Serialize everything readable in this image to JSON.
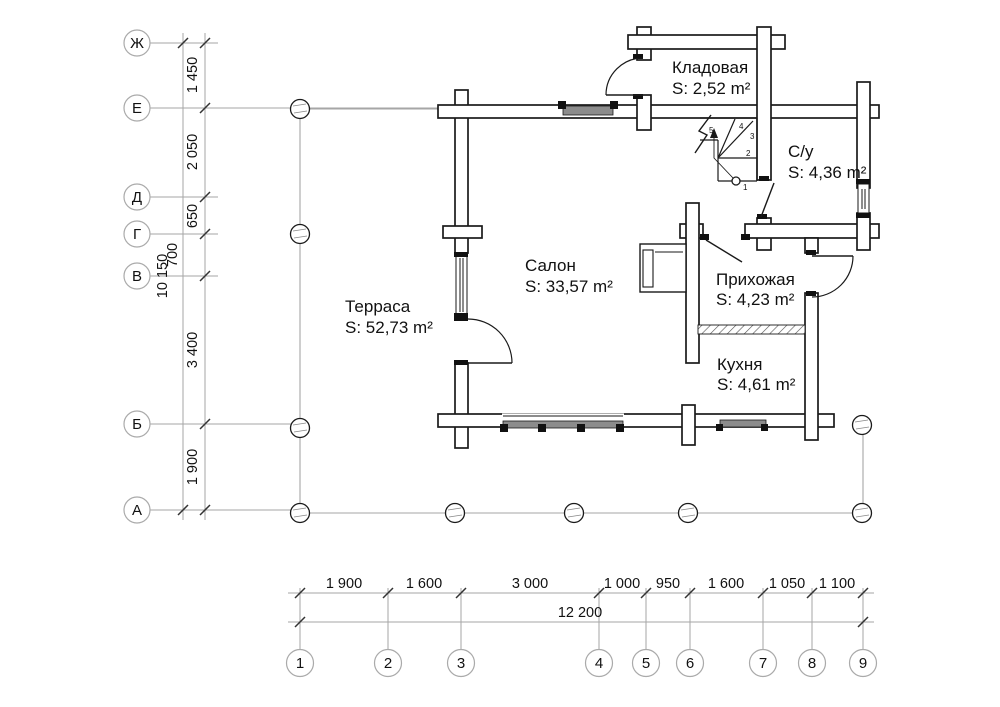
{
  "rooms": {
    "terrace": {
      "name": "Терраса",
      "area": "S: 52,73 m²"
    },
    "salon": {
      "name": "Салон",
      "area": "S: 33,57 m²"
    },
    "storage": {
      "name": "Кладовая",
      "area": "S: 2,52 m²"
    },
    "bathroom": {
      "name": "С/у",
      "area": "S: 4,36 m²"
    },
    "hallway": {
      "name": "Прихожая",
      "area": "S: 4,23 m²"
    },
    "kitchen": {
      "name": "Кухня",
      "area": "S: 4,61 m²"
    }
  },
  "left_axis": {
    "labels": [
      "Ж",
      "Е",
      "Д",
      "Г",
      "В",
      "Б",
      "А"
    ],
    "dims": [
      "1 450",
      "2 050",
      "650",
      "700",
      "3 400",
      "1 900"
    ],
    "total": "10 150"
  },
  "bottom_axis": {
    "labels": [
      "1",
      "2",
      "3",
      "4",
      "5",
      "6",
      "7",
      "8",
      "9"
    ],
    "dims": [
      "1 900",
      "1 600",
      "3 000",
      "1 000",
      "950",
      "1 600",
      "1 050",
      "1 100"
    ],
    "total": "12 200"
  },
  "stairs": {
    "steps": [
      "1",
      "2",
      "3",
      "4",
      "5"
    ]
  },
  "colors": {
    "wall_stroke": "#1a1a1a",
    "thin_line": "#a6a6a6",
    "dim_line": "#666666",
    "window_band": "#8c8c8c"
  }
}
